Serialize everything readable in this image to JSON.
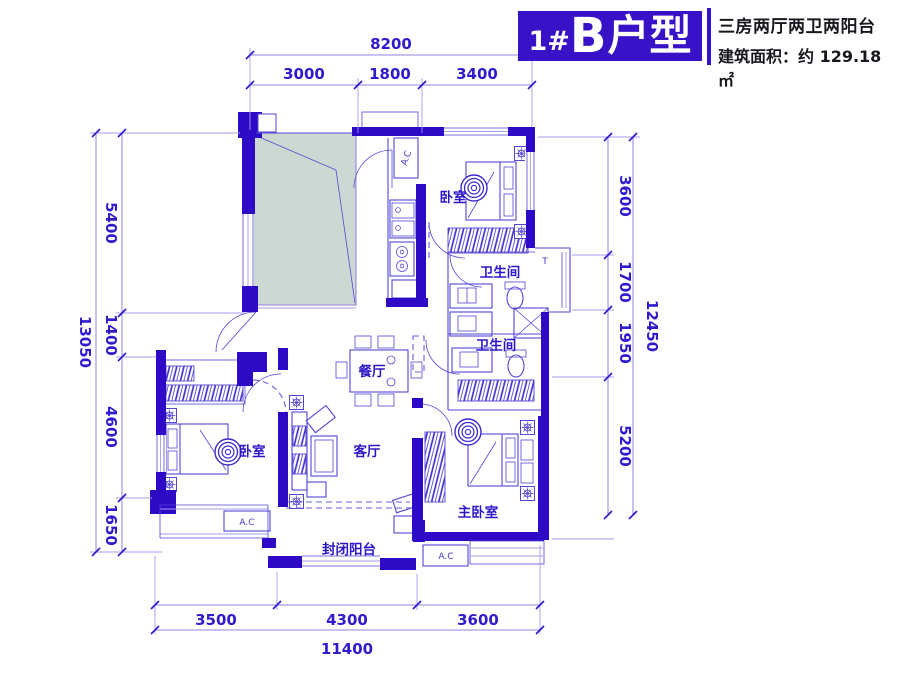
{
  "header": {
    "title_prefix": "1#",
    "title_letter": "B",
    "title_suffix": "户型",
    "subtitle": "三房两厅两卫两阳台",
    "area": "建筑面积：约 129.18 ㎡"
  },
  "dims": {
    "top": {
      "total": "8200",
      "seg": [
        "3000",
        "1800",
        "3400"
      ]
    },
    "left": {
      "total": "13050",
      "seg": [
        "5400",
        "1400",
        "4600",
        "1650"
      ]
    },
    "right": {
      "total": "12450",
      "seg": [
        "3600",
        "1700",
        "1950",
        "5200"
      ]
    },
    "bottom": {
      "total": "11400",
      "seg": [
        "3500",
        "4300",
        "3600"
      ]
    }
  },
  "rooms": {
    "bedroom_top": "卧室",
    "bath_upper": "卫生间",
    "bath_lower": "卫生间",
    "dining": "餐厅",
    "living": "客厅",
    "bedroom_left": "卧室",
    "master_bedroom": "主卧室",
    "balcony": "封闭阳台"
  },
  "marks": {
    "ac": "A.C",
    "t": "T"
  },
  "colors": {
    "wall": "#2E0AC6",
    "line": "#5346D8",
    "dim_text": "#2F1BCE",
    "title_bg": "#3812C6",
    "void_fill": "#CCD8D2",
    "header_text": "#17171F"
  }
}
